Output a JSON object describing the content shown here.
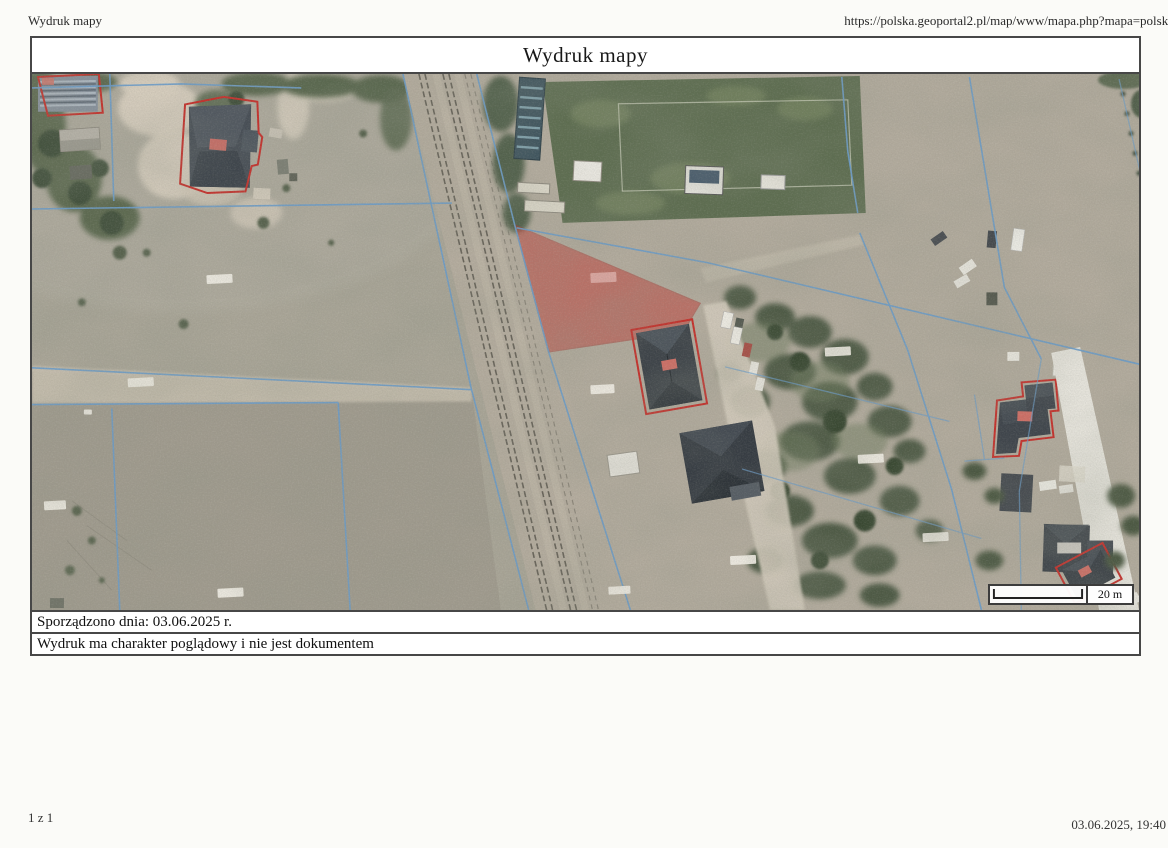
{
  "header": {
    "app_title": "Wydruk mapy",
    "url": "https://polska.geoportal2.pl/map/www/mapa.php?mapa=polska"
  },
  "map": {
    "title": "Wydruk mapy",
    "prepared_line": "Sporządzono dnia: 03.06.2025 r.",
    "disclaimer_line": "Wydruk ma charakter poglądowy i nie jest dokumentem",
    "scale_label": "20 m"
  },
  "footer": {
    "page_indicator": "1 z 1",
    "datetime": "03.06.2025, 19:40"
  },
  "colors": {
    "highlight_parcel_fill": "#c03e36",
    "building_outline_red": "#c52f2a",
    "cadastral_line_blue": "#6b9cc9",
    "frame_border": "#474747"
  },
  "features": [
    "highlighted-parcel",
    "railway-line",
    "sports-field",
    "red-outlined-buildings",
    "cadastral-boundaries",
    "dirt-roads",
    "tree-clusters"
  ]
}
